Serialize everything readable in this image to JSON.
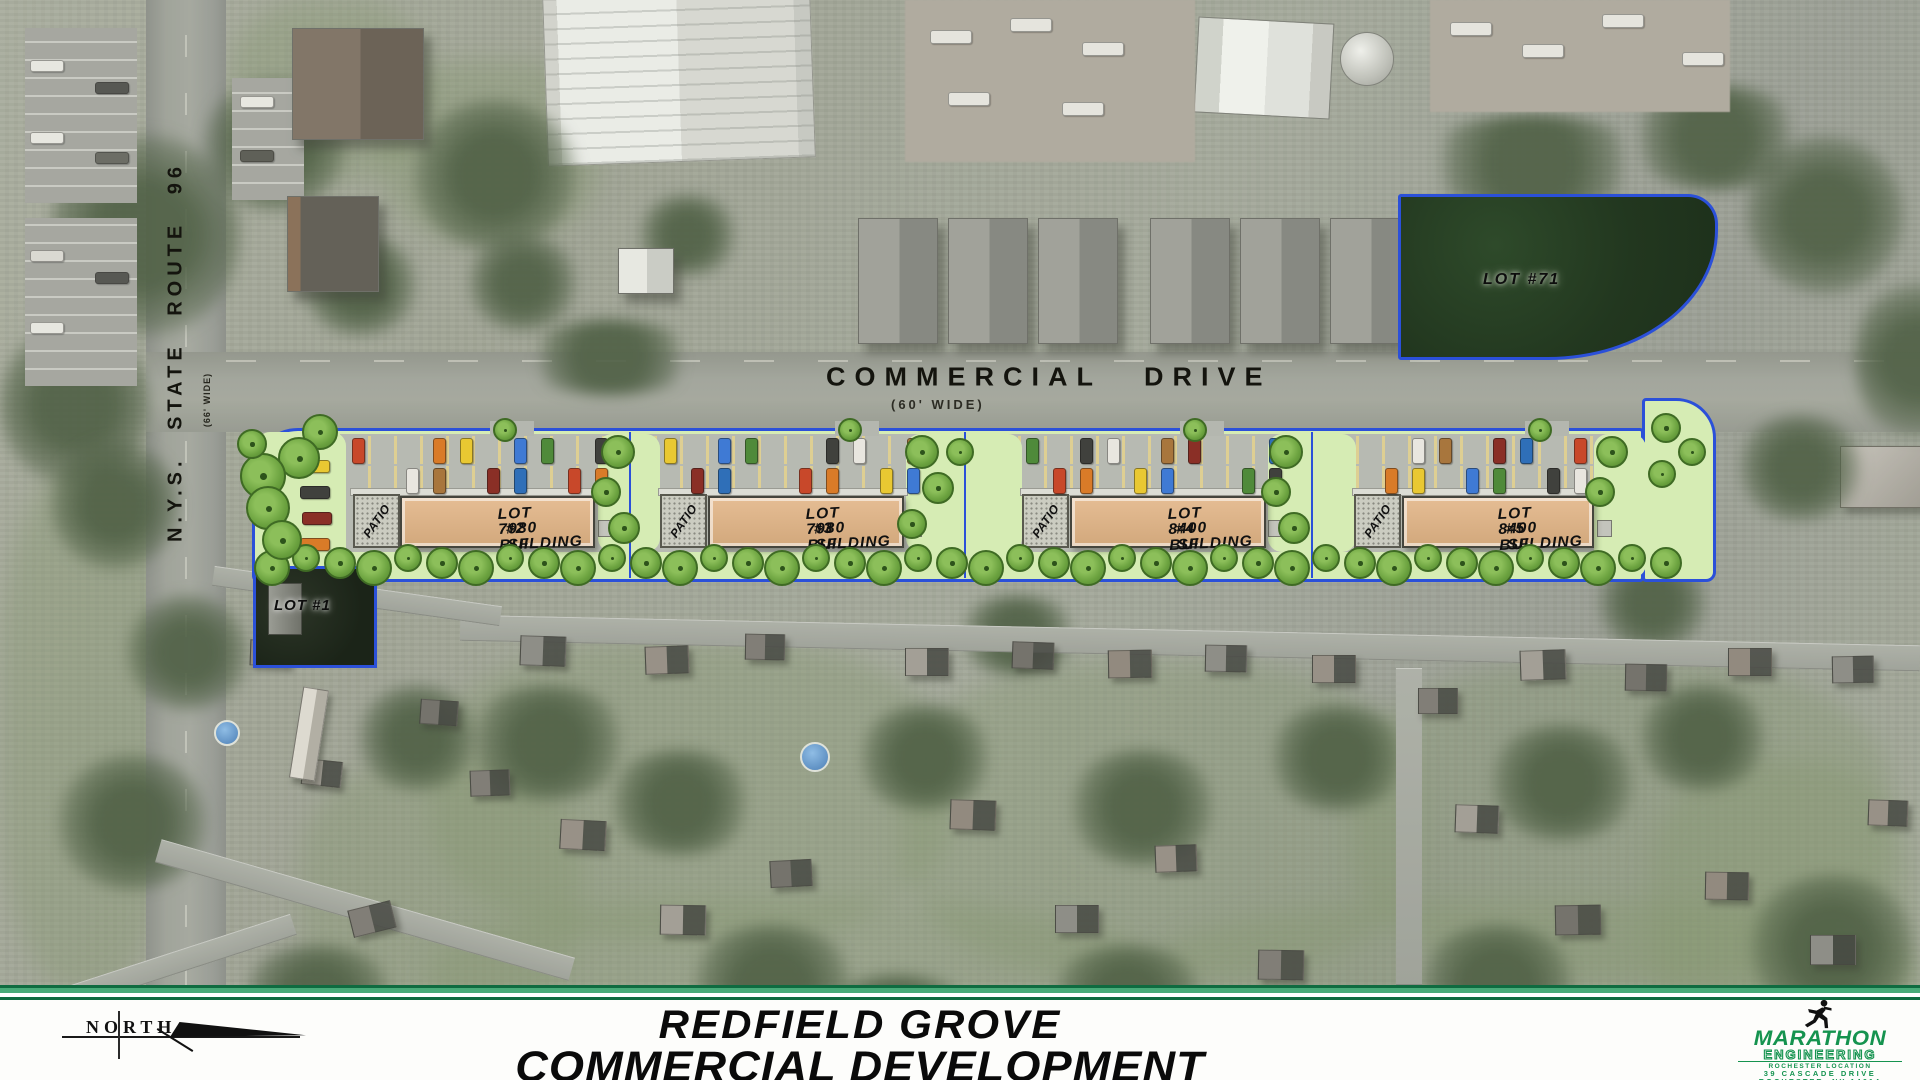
{
  "roads": {
    "route96": {
      "name": "N.Y.S. STATE ROUTE 96",
      "width_note": "(66' WIDE)"
    },
    "commercial": {
      "name": "COMMERCIAL DRIVE",
      "width_note": "(60' WIDE)"
    }
  },
  "site": {
    "lots": [
      {
        "id": "lot-1",
        "label": "LOT #1"
      },
      {
        "id": "lot-2",
        "label": "LOT #2",
        "size": "7980 SF",
        "type": "BUILDING",
        "patio_label": "PATIO"
      },
      {
        "id": "lot-3",
        "label": "LOT #3",
        "size": "7980 SF",
        "type": "BUILDING",
        "patio_label": "PATIO"
      },
      {
        "id": "lot-4",
        "label": "LOT #4",
        "size": "8400 SF",
        "type": "BUILDING",
        "patio_label": "PATIO"
      },
      {
        "id": "lot-5",
        "label": "LOT #5",
        "size": "8400 SF",
        "type": "BUILDING",
        "patio_label": "PATIO"
      },
      {
        "id": "lot-71",
        "label": "LOT #71"
      }
    ]
  },
  "footer": {
    "title_line1": "REDFIELD GROVE",
    "title_line2": "COMMERCIAL DEVELOPMENT",
    "north_label": "NORTH",
    "firm": {
      "name": "MARATHON",
      "division": "ENGINEERING",
      "location_label": "ROCHESTER LOCATION",
      "address_line1": "39 CASCADE DRIVE",
      "address_line2": "ROCHESTER, NY 14614",
      "phone": "585-458-7770"
    }
  },
  "colors": {
    "boundary_blue": "#2b50d9",
    "landscape_green": "#d6ecb4",
    "tree_green": "#6ba23f",
    "building_tan": "#d9b089",
    "pavement_gray": "#b7bab2",
    "brand_green": "#15934f",
    "cars": [
      "#c8482a",
      "#d97b28",
      "#e9c832",
      "#3f7ad4",
      "#4f8a3a",
      "#40413d",
      "#e8e6df",
      "#a8763d",
      "#8a2f26",
      "#2f6fb8"
    ]
  }
}
